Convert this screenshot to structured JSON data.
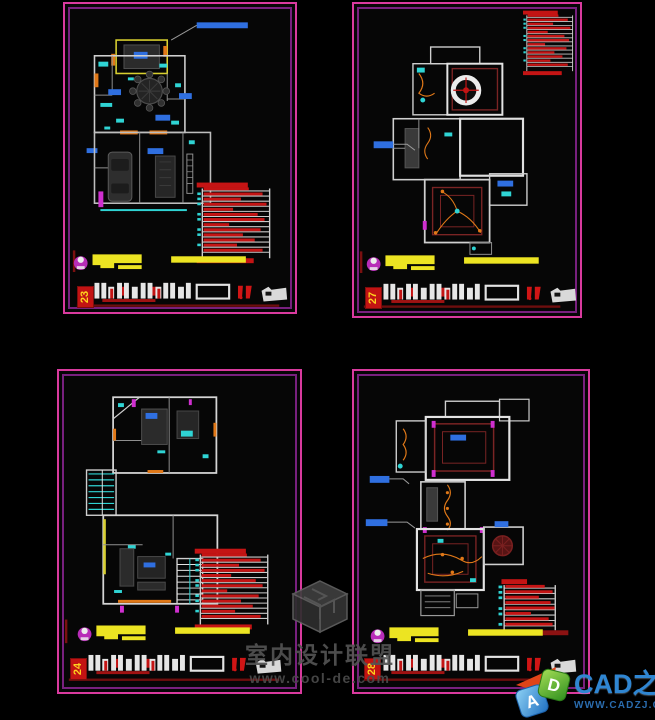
{
  "canvas": {
    "background": "#000000"
  },
  "sheets": [
    {
      "number": "23"
    },
    {
      "number": "27"
    },
    {
      "number": "24"
    },
    {
      "number": "28"
    }
  ],
  "watermark": {
    "site_name": "室内设计联盟",
    "site_url": "www.cool-de.com"
  },
  "brand": {
    "name": "CAD之家",
    "url": "WWW.CADZJ.COM",
    "cube_letter_a": "A",
    "cube_letter_d": "D"
  },
  "colors": {
    "frame_outer": "#d93a9e",
    "frame_inner": "#78207e",
    "sheet_number_bg": "#c21313",
    "sheet_number_text": "#ffd21f",
    "legend_red": "#c41414",
    "title_bar_yellow": "#ece422",
    "accent_cyan": "#2fd4d4",
    "accent_orange": "#e07818",
    "accent_blue": "#2f6fe0",
    "accent_magenta": "#cf2fcf",
    "wall_white": "#d8d8d8",
    "ceiling_maroon": "#7a2424"
  }
}
